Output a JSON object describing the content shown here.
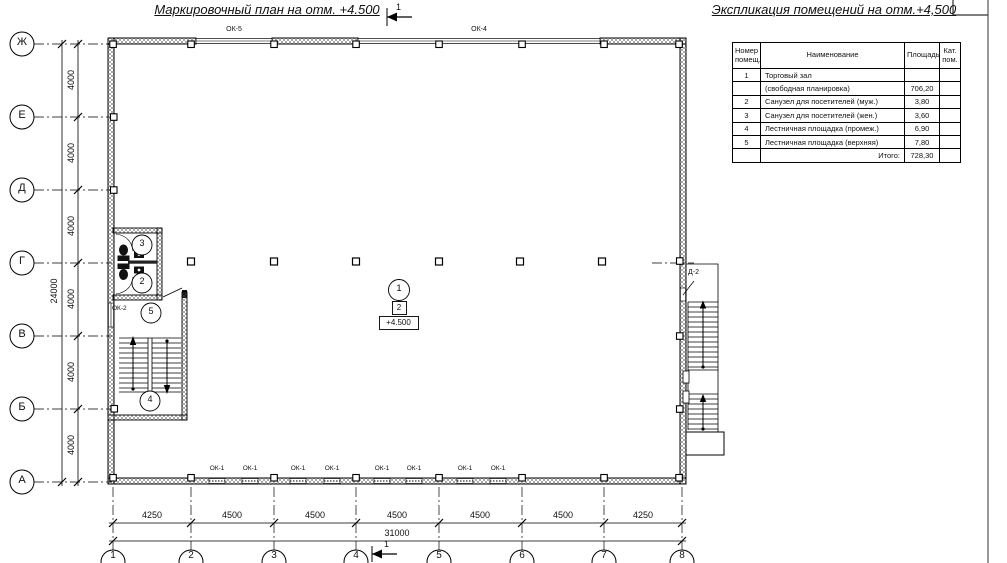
{
  "titles": {
    "plan": "Маркировочный план на отм. +4.500",
    "explication": "Экспликация помещений на отм.+4,500"
  },
  "section_marks": {
    "top": "1",
    "bottom": "1"
  },
  "axes": {
    "rows": [
      "Ж",
      "Е",
      "Д",
      "Г",
      "В",
      "Б",
      "А"
    ],
    "cols": [
      "1",
      "2",
      "3",
      "4",
      "5",
      "6",
      "7",
      "8"
    ]
  },
  "dims": {
    "v_segments": [
      "4000",
      "4000",
      "4000",
      "4000",
      "4000",
      "4000"
    ],
    "v_total": "24000",
    "h_segments": [
      "4250",
      "4500",
      "4500",
      "4500",
      "4500",
      "4500",
      "4250"
    ],
    "h_total": "31000"
  },
  "windows": {
    "ok5": "ОК-5",
    "ok4": "ОК-4",
    "ok2": "ОК-2",
    "ok1": [
      "ОК-1",
      "ОК-1",
      "ОК-1",
      "ОК-1",
      "ОК-1",
      "ОК-1",
      "ОК-1",
      "ОК-1"
    ]
  },
  "doors": {
    "d2": "Д-2"
  },
  "rooms": {
    "hall": "1",
    "wc_m": "2",
    "wc_f": "3",
    "stair": "4",
    "landing": "5"
  },
  "marks": {
    "zone": "2",
    "level": "+4.500"
  },
  "table": {
    "headers": [
      "Номер помещ.",
      "Наименование",
      "Площадь",
      "Кат. пом."
    ],
    "rows": [
      [
        "1",
        "Торговый зал",
        "",
        ""
      ],
      [
        "",
        "(свободная планировка)",
        "706,20",
        ""
      ],
      [
        "2",
        "Санузел для посетителей (муж.)",
        "3,80",
        ""
      ],
      [
        "3",
        "Санузел для посетителей (жен.)",
        "3,60",
        ""
      ],
      [
        "4",
        "Лестничная площадка (промеж.)",
        "6,90",
        ""
      ],
      [
        "5",
        "Лестничная площадка (верхняя)",
        "7,80",
        ""
      ],
      [
        "",
        "Итого:",
        "728,30",
        ""
      ]
    ]
  }
}
